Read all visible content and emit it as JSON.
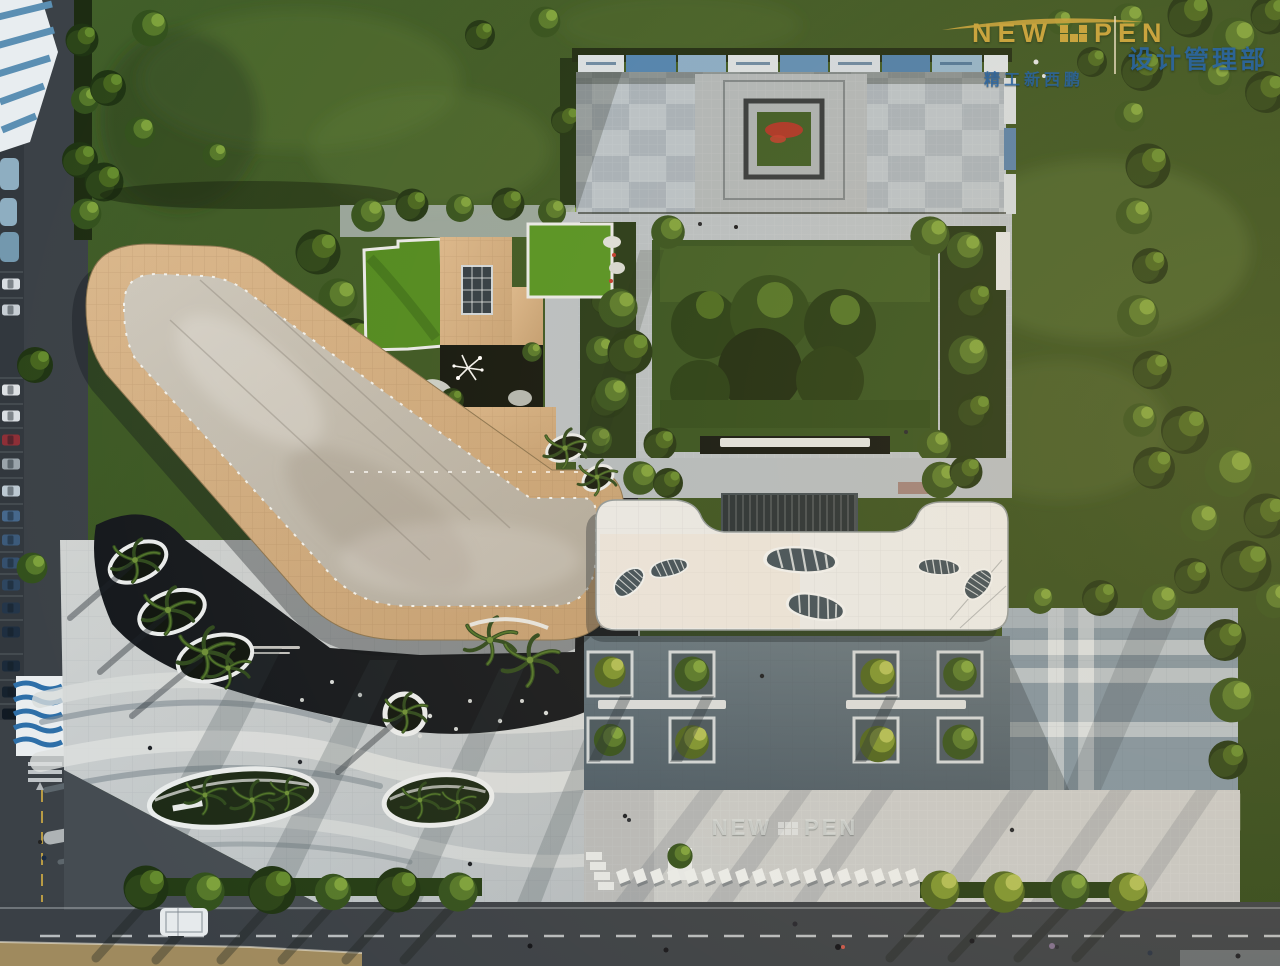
{
  "watermark": {
    "brand_left": "NEW",
    "brand_right": "PEN",
    "brand_symbol": "gold-checker-blocks",
    "tagline": "精工新西鹏",
    "department": "设计管理部",
    "brand_color": "#c9a43e",
    "text_color": "#2b6aac"
  },
  "ground_logo": {
    "left": "NEW",
    "right": "PEN",
    "symbol": "checker-blocks"
  },
  "scene": {
    "description": "Aerial drone view of a sales-center campus at golden hour: boomerang-shaped tan-tile roof with grey concrete core, white roof with leaf-shaped skylights, checkered entry-plaza roof with banner wall and red flower planter, garden courtyard, curved white palm planters over dark paving, plaid-paved plaza, tree-lined streets with parked cars and a white bus",
    "palette": {
      "grass": "#3f5b26",
      "tan_roof": "#d2af85",
      "concrete": "#c6c1b6",
      "plaza_light": "#c6cbcd",
      "plaza_dark": "#5c6e7b",
      "water_dark": "#14181d",
      "road": "#3a4046",
      "white_roof": "#e8eae9",
      "skylight": "#3e4f59",
      "banner_blue": "#4d82b1",
      "lawn_bright": "#4f8a1f",
      "flower_red": "#a83325"
    }
  }
}
